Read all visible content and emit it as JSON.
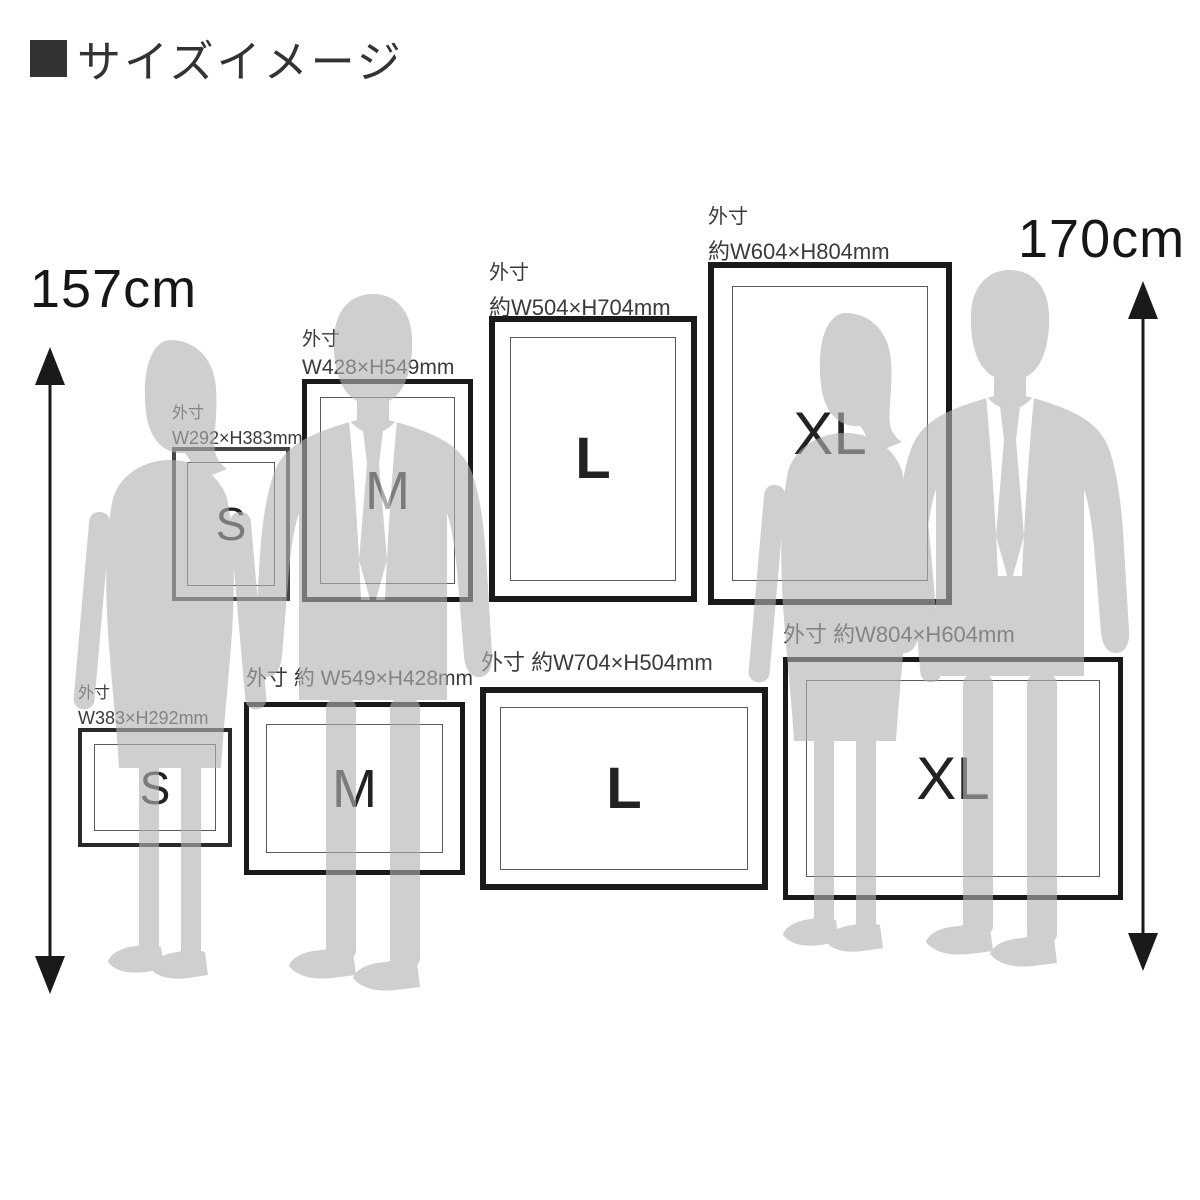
{
  "title": {
    "text": "サイズイメージ"
  },
  "measures": {
    "left": "157cm",
    "right": "170cm"
  },
  "frames": {
    "portrait": [
      {
        "size": "S",
        "letter": "S",
        "label_lines": [
          "外寸",
          "W292×H383mm"
        ]
      },
      {
        "size": "M",
        "letter": "M",
        "label_lines": [
          "外寸",
          "W428×H549mm"
        ]
      },
      {
        "size": "L",
        "letter": "L",
        "label_lines": [
          "外寸",
          "約W504×H704mm"
        ]
      },
      {
        "size": "XL",
        "letter": "XL",
        "label_lines": [
          "外寸",
          "約W604×H804mm"
        ]
      }
    ],
    "landscape": [
      {
        "size": "S",
        "letter": "S",
        "label_lines": [
          "外寸",
          "W383×H292mm"
        ]
      },
      {
        "size": "M",
        "letter": "M",
        "label_lines": [
          "外寸 約 W549×H428mm"
        ]
      },
      {
        "size": "L",
        "letter": "L",
        "label_lines": [
          "外寸 約W704×H504mm"
        ]
      },
      {
        "size": "XL",
        "letter": "XL",
        "label_lines": [
          "外寸 約W804×H604mm"
        ]
      }
    ]
  },
  "colors": {
    "background": "#ffffff",
    "silhouette_gray": "#d2d2d2",
    "frame_border": "#1a1a1a",
    "letter_text": "#222222",
    "label_text": "#3a3a3a",
    "title_text": "#333333",
    "arrow": "#1a1a1a"
  }
}
